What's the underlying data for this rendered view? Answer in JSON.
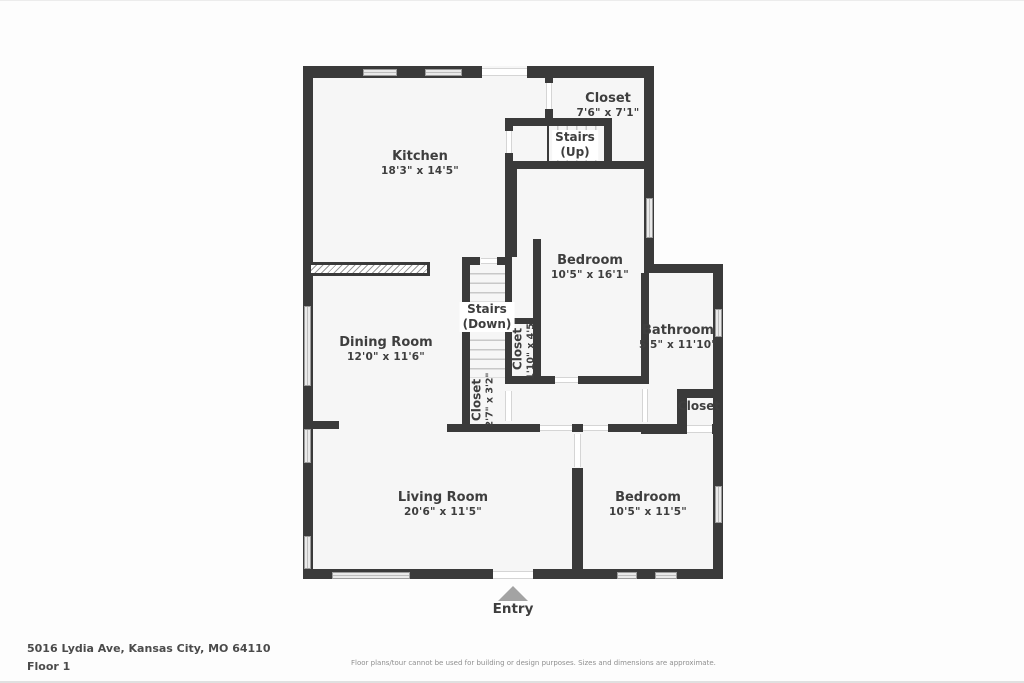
{
  "page": {
    "entry_label": "Entry"
  },
  "rooms": [
    {
      "id": "kitchen",
      "name": "Kitchen",
      "dims": "18'3\" x 14'5\""
    },
    {
      "id": "closet-top",
      "name": "Closet",
      "dims": "7'6\" x 7'1\""
    },
    {
      "id": "stairs-up",
      "name": "Stairs",
      "line2": "(Up)"
    },
    {
      "id": "bedroom-upper",
      "name": "Bedroom",
      "dims": "10'5\" x 16'1\""
    },
    {
      "id": "bathroom",
      "name": "Bathroom",
      "dims": "5'5\" x 11'10\""
    },
    {
      "id": "stairs-down",
      "name": "Stairs",
      "line2": "(Down)"
    },
    {
      "id": "closet-hall",
      "name": "Closet",
      "dims": "1'10\" x 4'5\""
    },
    {
      "id": "dining-room",
      "name": "Dining Room",
      "dims": "12'0\" x 11'6\""
    },
    {
      "id": "closet-under-stairs",
      "name": "Closet",
      "dims": "2'7\" x 3'2\""
    },
    {
      "id": "closet-bedroom2",
      "name": "Closet"
    },
    {
      "id": "living-room",
      "name": "Living Room",
      "dims": "20'6\" x 11'5\""
    },
    {
      "id": "bedroom-lower",
      "name": "Bedroom",
      "dims": "10'5\" x 11'5\""
    }
  ],
  "footer": {
    "address": "5016 Lydia Ave, Kansas City, MO 64110",
    "floor": "Floor 1",
    "disclaimer": "Floor plans/tour cannot be used for building or design purposes. Sizes and dimensions are approximate."
  },
  "colors": {
    "wall": "#3a3a3a",
    "room_fill": "#f6f6f6",
    "window_fill": "#e9e9e9",
    "stair_tread": "#c8c8c8",
    "entry_arrow": "#a3a3a3",
    "label_text": "#3e3e3e"
  }
}
